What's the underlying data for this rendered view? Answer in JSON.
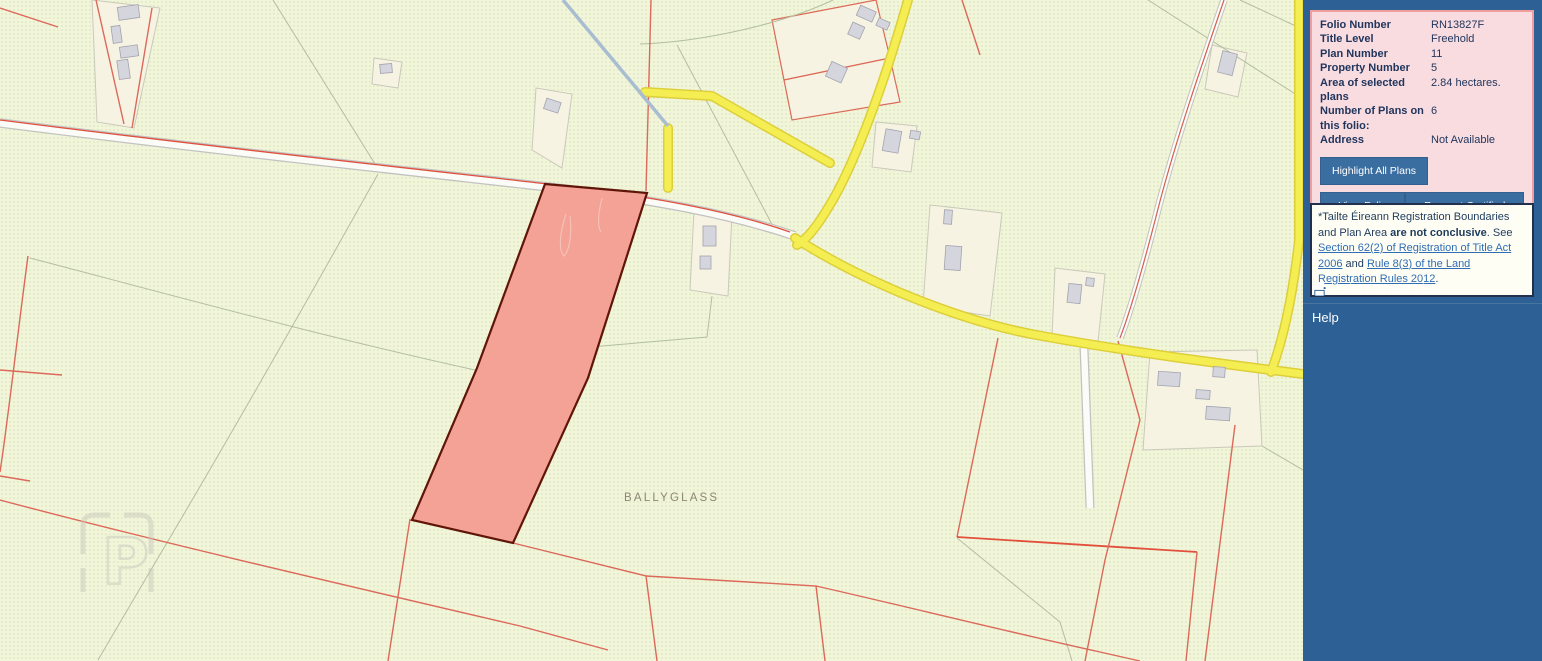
{
  "map": {
    "townland_label": "BALLYGLASS",
    "watermark_letter": "P",
    "highlight_parcel_color": "#f3a295",
    "road_color_regional": "#f4ee52",
    "boundary_color": "#dc695a"
  },
  "sidebar": {
    "background_color": "#2d6095",
    "folio_panel": {
      "background_color": "#f9dce0",
      "border_color": "#f09d9d",
      "rows": [
        {
          "label": "Folio Number",
          "value": "RN13827F"
        },
        {
          "label": "Title Level",
          "value": "Freehold"
        },
        {
          "label": "Plan Number",
          "value": "11"
        },
        {
          "label": "Property Number",
          "value": "5"
        },
        {
          "label": "Area of selected plans",
          "value": "2.84 hectares."
        },
        {
          "label": "Number of Plans on this folio:",
          "value": "6"
        },
        {
          "label": "Address",
          "value": "Not Available"
        }
      ],
      "buttons": [
        {
          "label": "Highlight All Plans"
        },
        {
          "label": "View Folio PDF"
        },
        {
          "label": "Request Certified Copy"
        }
      ],
      "button_color": "#3a6da0"
    },
    "disclaimer": {
      "text_prefix": "*Tailte Éireann Registration Boundaries and Plan Area ",
      "text_bold": "are not conclusive",
      "text_mid": ". See ",
      "link_1": "Section 62(2) of Registration of Title Act 2006",
      "text_and": " and ",
      "link_2": "Rule 8(3) of the Land Registration Rules 2012",
      "text_suffix": "."
    },
    "print_button_label": "Print Current View",
    "help_label": "Help"
  }
}
